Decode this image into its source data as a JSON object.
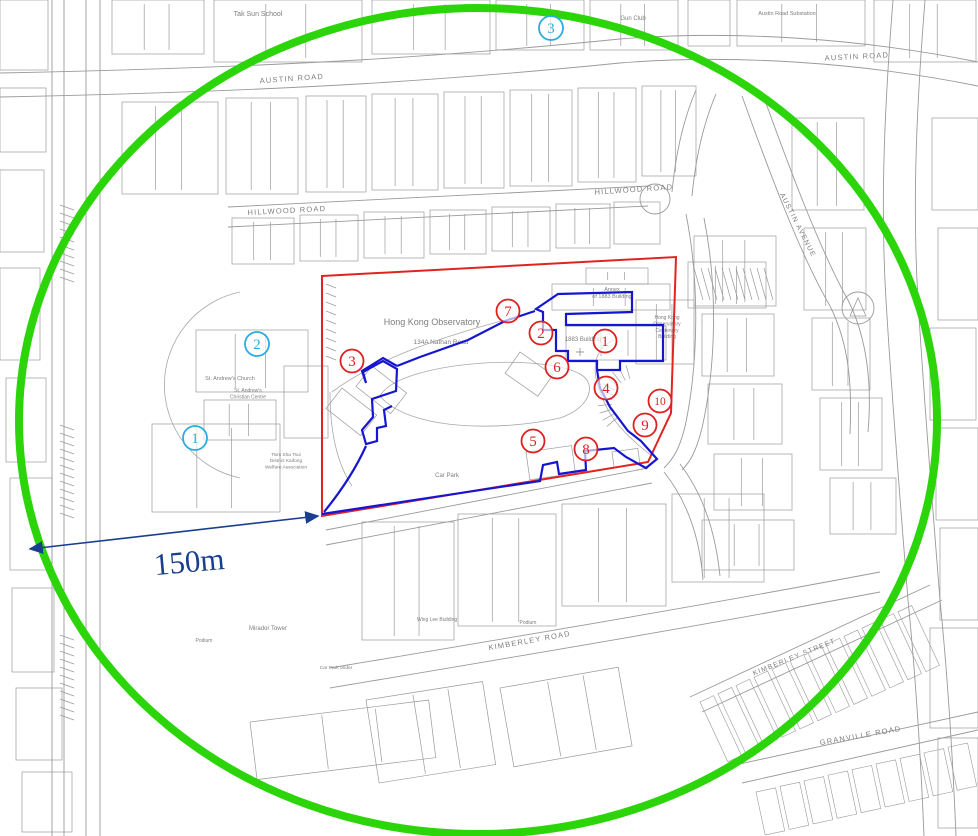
{
  "map": {
    "background": "#ffffff",
    "line_color": "#9a9a9a",
    "label_color": "#7d7d7d",
    "street_labels": [
      {
        "text": "AUSTIN ROAD",
        "x": 292,
        "y": 81,
        "rot": -4,
        "size": 7.5
      },
      {
        "text": "AUSTIN ROAD",
        "x": 857,
        "y": 59,
        "rot": -3,
        "size": 7.5
      },
      {
        "text": "HILLWOOD ROAD",
        "x": 287,
        "y": 213,
        "rot": -3,
        "size": 7.5
      },
      {
        "text": "HILLWOOD ROAD",
        "x": 634,
        "y": 192,
        "rot": -4,
        "size": 7.5
      },
      {
        "text": "KIMBERLEY ROAD",
        "x": 530,
        "y": 643,
        "rot": -10,
        "size": 7.5
      },
      {
        "text": "KIMBERLEY STREET",
        "x": 795,
        "y": 659,
        "rot": -22,
        "size": 7
      },
      {
        "text": "GRANVILLE ROAD",
        "x": 861,
        "y": 738,
        "rot": -10,
        "size": 7.5
      },
      {
        "text": "AUSTIN AVENUE",
        "x": 796,
        "y": 226,
        "rot": 63,
        "size": 7
      }
    ],
    "place_labels": [
      {
        "lines": [
          "Hong Kong Observatory"
        ],
        "x": 432,
        "y": 325,
        "size": 9
      },
      {
        "lines": [
          "134A Nathan Road"
        ],
        "x": 441,
        "y": 344,
        "size": 6.5
      },
      {
        "lines": [
          "1883 Building"
        ],
        "x": 583,
        "y": 341,
        "size": 6
      },
      {
        "lines": [
          "Annex",
          "of 1883 Building"
        ],
        "x": 612,
        "y": 291,
        "size": 5.5
      },
      {
        "lines": [
          "Hong Kong",
          "Observatory",
          "Centenary",
          "Building"
        ],
        "x": 667,
        "y": 319,
        "size": 5
      },
      {
        "lines": [
          "Tak Sun School"
        ],
        "x": 258,
        "y": 16,
        "size": 7
      },
      {
        "lines": [
          "Austin Road Substation"
        ],
        "x": 787,
        "y": 15,
        "size": 5.5
      },
      {
        "lines": [
          "Gun Club"
        ],
        "x": 633,
        "y": 20,
        "size": 6
      },
      {
        "lines": [
          "St. Andrew's Church"
        ],
        "x": 230,
        "y": 380,
        "size": 5.5
      },
      {
        "lines": [
          "St. Andrew's",
          "Christian Centre"
        ],
        "x": 248,
        "y": 392,
        "size": 5
      },
      {
        "lines": [
          "Tsim Sha Tsui",
          "District Kaifong",
          "Welfare Association"
        ],
        "x": 286,
        "y": 456,
        "size": 4.8
      },
      {
        "lines": [
          "Car Park"
        ],
        "x": 447,
        "y": 477,
        "size": 6
      },
      {
        "lines": [
          "Mirador Tower"
        ],
        "x": 268,
        "y": 630,
        "size": 6
      },
      {
        "lines": [
          "Wing Lee Building"
        ],
        "x": 437,
        "y": 621,
        "size": 5
      },
      {
        "lines": [
          "Podium"
        ],
        "x": 204,
        "y": 642,
        "size": 5
      },
      {
        "lines": [
          "Podium"
        ],
        "x": 528,
        "y": 624,
        "size": 5
      },
      {
        "lines": [
          "Car Park under"
        ],
        "x": 336,
        "y": 669,
        "size": 4.8
      }
    ]
  },
  "overlays": {
    "green_circle": {
      "cx": 478,
      "cy": 421,
      "rx": 459,
      "ry": 413,
      "color": "#2bd50a",
      "width": 8
    },
    "red_boundary": {
      "points": "322,276 676,257 671,413 648,462 322,516",
      "color": "#e02420",
      "width": 2
    },
    "blue_boundary": {
      "color": "#1616d0",
      "width": 2.2,
      "paths": [
        "M322,514 L540,481 L543,465 L557,462 L559,474 L586,470 L585,451 L614,448 L626,457 L646,468 L657,459 L641,441 L628,431 L610,407 L600,388 L597,370",
        "M597,370 L597,361 L568,361 L568,351 L556,351 L556,330 L543,330 L543,312 L536,309 L558,294 L632,292 L632,312 L566,314 L566,325 L663,325 L663,361 L620,361 L620,370 L597,370",
        "M535,311 L505,321 L468,340 L420,357 L397,366",
        "M397,366 L383,358 L362,371 L366,383 L363,372 L383,361 L397,369 L396,391 L372,399 L373,417 L362,430 L366,444 L377,441 L377,428 L386,426 L384,410 L392,406",
        "M366,446 C356,468 342,490 324,512"
      ]
    },
    "scale_arrow": {
      "label": "150m",
      "x1": 30,
      "y1": 549,
      "x2": 318,
      "y2": 516,
      "color": "#1a3f8f",
      "label_x": 190,
      "label_y": 572,
      "label_size": 31,
      "label_rot": -5
    }
  },
  "markers": {
    "red": {
      "color": "#e01f1f",
      "items": [
        {
          "label": "1",
          "x": 605,
          "y": 341
        },
        {
          "label": "2",
          "x": 541,
          "y": 333
        },
        {
          "label": "3",
          "x": 352,
          "y": 361
        },
        {
          "label": "4",
          "x": 606,
          "y": 388
        },
        {
          "label": "5",
          "x": 533,
          "y": 441
        },
        {
          "label": "6",
          "x": 557,
          "y": 367
        },
        {
          "label": "7",
          "x": 508,
          "y": 311
        },
        {
          "label": "8",
          "x": 586,
          "y": 449
        },
        {
          "label": "9",
          "x": 645,
          "y": 425
        },
        {
          "label": "10",
          "x": 660,
          "y": 401
        }
      ]
    },
    "cyan": {
      "color": "#2aace3",
      "items": [
        {
          "label": "1",
          "x": 195,
          "y": 438
        },
        {
          "label": "2",
          "x": 257,
          "y": 344
        },
        {
          "label": "3",
          "x": 551,
          "y": 28
        }
      ]
    }
  }
}
